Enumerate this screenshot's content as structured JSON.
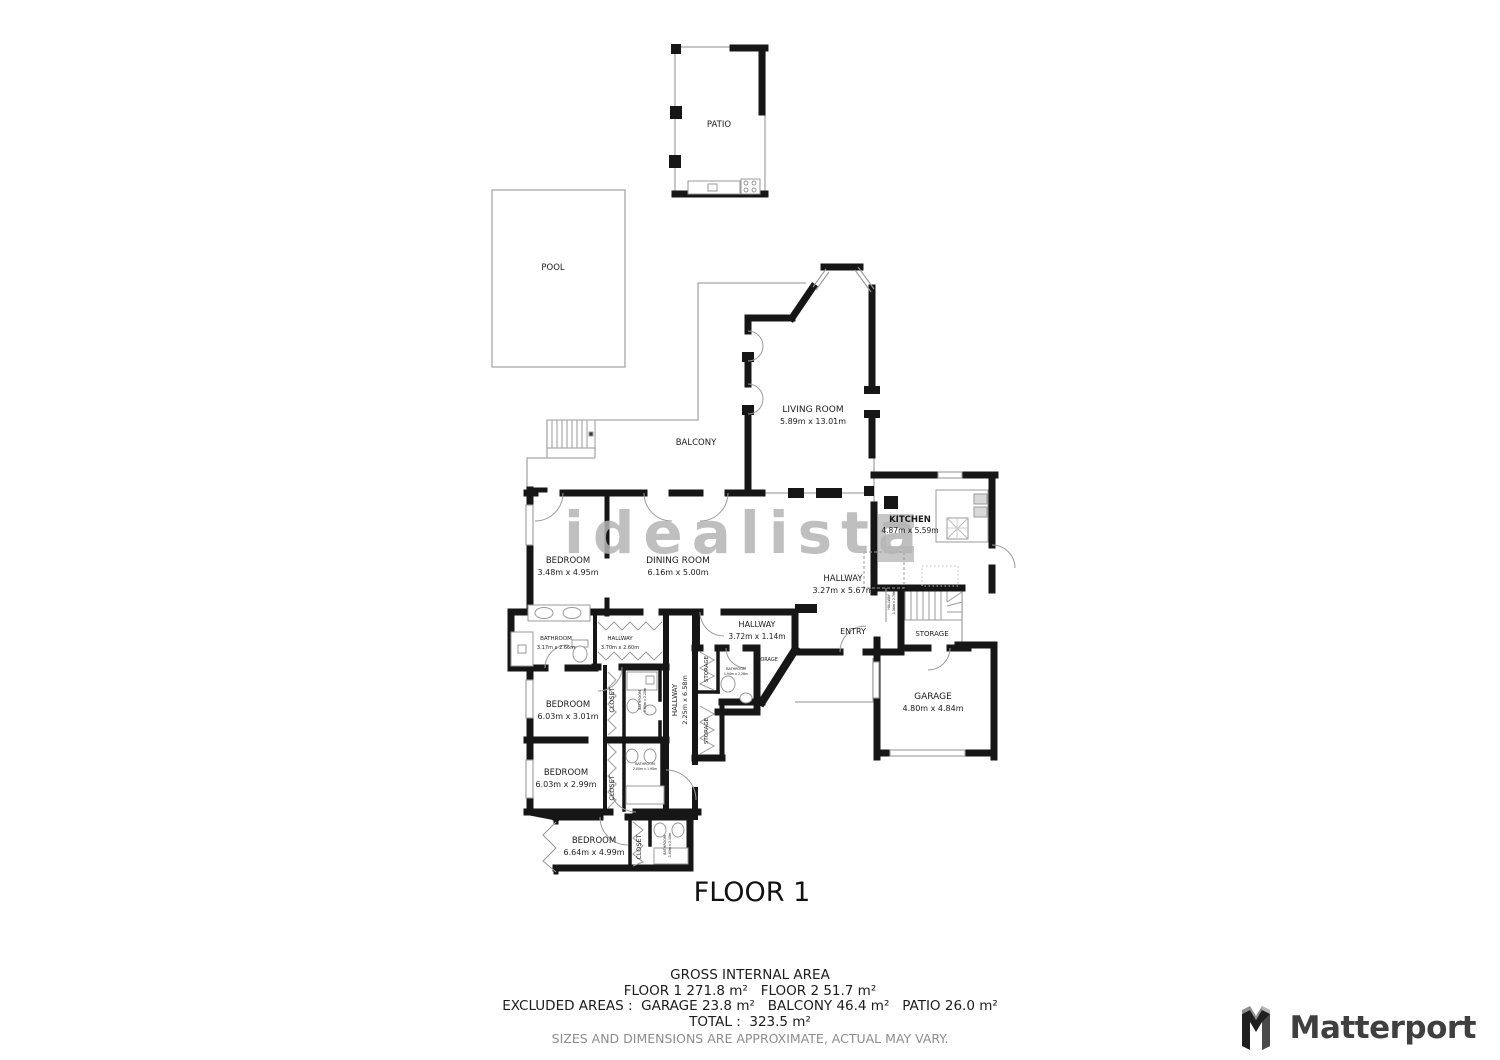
{
  "watermark": "idealista",
  "floor_title": "FLOOR 1",
  "rooms": {
    "patio": {
      "label": "PATIO"
    },
    "pool": {
      "label": "POOL"
    },
    "balcony": {
      "label": "BALCONY"
    },
    "living_room": {
      "label": "LIVING ROOM",
      "dims": "5.89m x 13.01m"
    },
    "kitchen": {
      "label": "KITCHEN",
      "dims": "4.87m x 5.59m"
    },
    "dining_room": {
      "label": "DINING ROOM",
      "dims": "6.16m x 5.00m"
    },
    "bedroom_1": {
      "label": "BEDROOM",
      "dims": "3.48m x 4.95m"
    },
    "bathroom_1": {
      "label": "BATHROOM",
      "dims": "3.17m x 2.66m"
    },
    "hallway_closet": {
      "label": "HALLWAY",
      "dims": "3.70m x 2.60m"
    },
    "hallway_main": {
      "label": "HALLWAY",
      "dims": "3.27m x 5.67m"
    },
    "hallway_small": {
      "label": "HALLWAY",
      "dims": "3.72m x 1.14m"
    },
    "hallway_stair": {
      "label": "HALLWAY",
      "dims": "1.06m x 2.76m"
    },
    "hallway_bedrooms": {
      "label": "HALLWAY",
      "dims": "2.25m x 6.58m"
    },
    "entry": {
      "label": "ENTRY"
    },
    "storage_stairs": {
      "label": "STORAGE"
    },
    "storage_entry": {
      "label": "STORAGE"
    },
    "storage_upper": {
      "label": "STORAGE"
    },
    "storage_lower": {
      "label": "STORAGE"
    },
    "garage": {
      "label": "GARAGE",
      "dims": "4.80m x 4.84m"
    },
    "bedroom_2": {
      "label": "BEDROOM",
      "dims": "6.03m x 3.01m"
    },
    "bedroom_3": {
      "label": "BEDROOM",
      "dims": "6.03m x 2.99m"
    },
    "bedroom_4": {
      "label": "BEDROOM",
      "dims": "6.64m x 4.99m"
    },
    "closet_1": {
      "label": "CLOSET"
    },
    "closet_2": {
      "label": "CLOSET"
    },
    "closet_3": {
      "label": "CLOSET"
    },
    "bathroom_2": {
      "label": "BATHROOM",
      "dims": "1.94m x 2.28m"
    },
    "bathroom_3": {
      "label": "BATHROOM",
      "dims": "1.80m x 2.20m"
    },
    "bathroom_4": {
      "label": "BATHROOM",
      "dims": "2.00m x 1.90m"
    },
    "bathroom_5": {
      "label": "BATHROOM",
      "dims": "1.80m x 2.10m"
    }
  },
  "footer": {
    "title": "GROSS INTERNAL AREA",
    "floors": "FLOOR 1 271.8 m²   FLOOR 2 51.7 m²",
    "excluded": "EXCLUDED AREAS :  GARAGE 23.8 m²   BALCONY 46.4 m²   PATIO 26.0 m²",
    "total": "TOTAL :  323.5 m²",
    "disclaimer": "SIZES AND DIMENSIONS ARE APPROXIMATE, ACTUAL MAY VARY."
  },
  "brand": {
    "name": "Matterport"
  }
}
